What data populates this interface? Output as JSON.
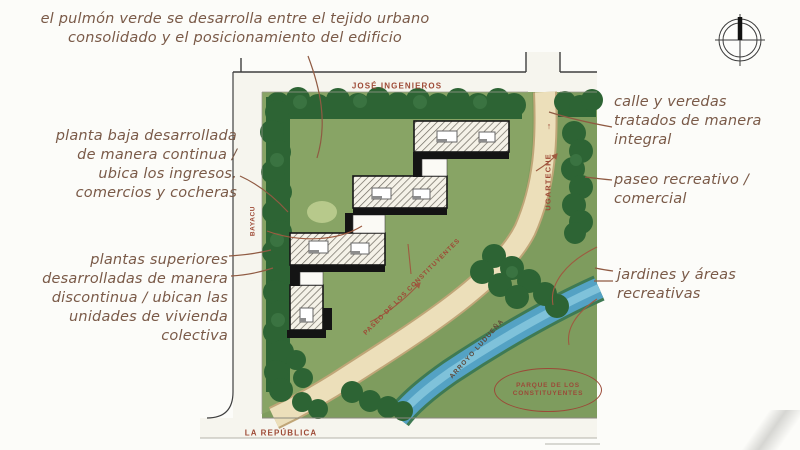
{
  "annotations": {
    "green_lung": "el pulmón verde se desarrolla entre el tejido urbano\nconsolidado y el posicionamiento del edificio",
    "ground_floor": "planta baja desarrollada\nde manera continua /\nubica los ingresos,\ncomercios y cocheras",
    "upper_floors": "plantas superiores\ndesarrolladas de manera\ndiscontinua / ubican las\nunidades de vivienda\ncolectiva",
    "street_sidewalks": "calle y veredas\ntratados de manera\nintegral",
    "promenade": "paseo recreativo /\ncomercial",
    "gardens": "jardines y áreas\nrecreativas"
  },
  "map": {
    "streets": {
      "north": "JOSÉ INGENIEROS",
      "east": "UGARTECHE",
      "east_direction_arrow": "↑",
      "west": "BAYACU",
      "south": "LA REPÚBLICA",
      "promenade": "PASEO DE LOS CONSTITUYENTES"
    },
    "water": "ARROYO LUDUEÑA",
    "park": "PARQUE DE LOS\nCONSTITUYENTES",
    "icons": {
      "north_indicator": "compass-icon",
      "street_direction": "up-arrow-icon"
    }
  },
  "colors": {
    "annotation_text": "#7a5a48",
    "street_label": "#9e4a36",
    "site_lawn": "#88a465",
    "park_green": "#7e9c5e",
    "tree_dark": "#2d6434",
    "path_beige": "#ecdfba",
    "water_blue": "#54a2c4",
    "building_hatch_bg": "#f5f2e8",
    "shadow_black": "#141414",
    "leader_brown": "#9e5b40"
  }
}
